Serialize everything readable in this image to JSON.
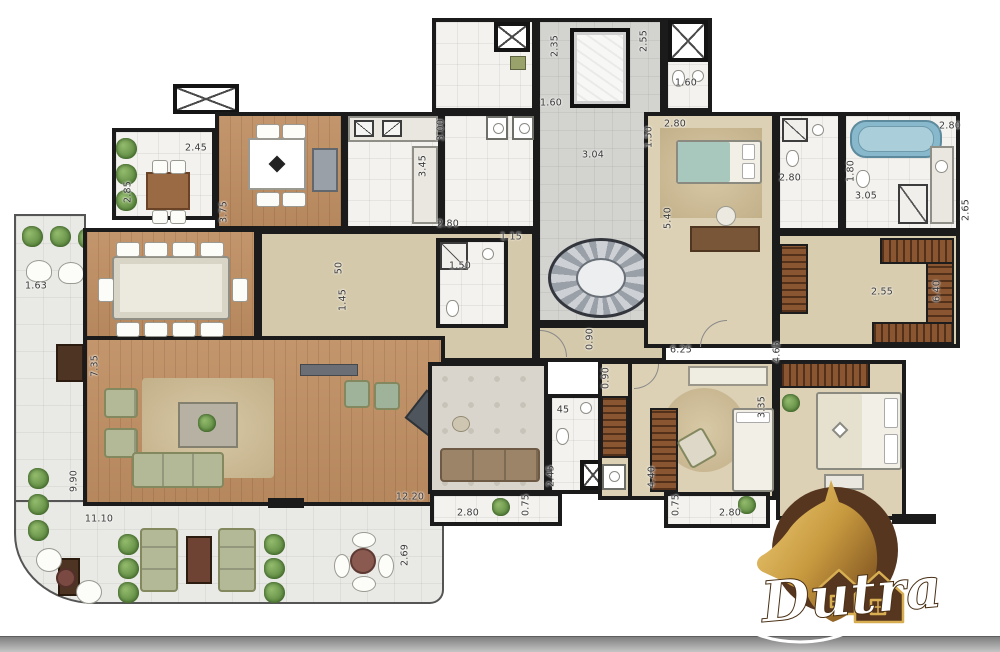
{
  "logo": {
    "brand": "Dutra"
  },
  "colors": {
    "wall": "#1b1b1b",
    "wood_floor": "#c08f63",
    "bedroom_floor": "#ddd1b5",
    "hall_floor": "#d5c9ab",
    "tile_floor": "#f3f2ee",
    "terrace_floor": "#e9e9e5",
    "bathtub_blue": "#87b8cc",
    "wardrobe_brown": "#8a5632",
    "sofa_green": "#b3b896",
    "logo_gold": "#d8ae52",
    "logo_brown": "#57361f",
    "bottom_bar_gray": "#b5b5b5"
  },
  "dimension_labels": [
    {
      "t": "2.45",
      "x": 196,
      "y": 148,
      "r": 0
    },
    {
      "t": "2.85",
      "x": 128,
      "y": 192,
      "r": -90
    },
    {
      "t": "3.75",
      "x": 224,
      "y": 212,
      "r": -90
    },
    {
      "t": "3.45",
      "x": 423,
      "y": 166,
      "r": -90
    },
    {
      "t": "3.00",
      "x": 441,
      "y": 130,
      "r": -90
    },
    {
      "t": "2.35",
      "x": 555,
      "y": 46,
      "r": -90
    },
    {
      "t": "2.55",
      "x": 644,
      "y": 41,
      "r": -90
    },
    {
      "t": "1.60",
      "x": 551,
      "y": 103,
      "r": 0
    },
    {
      "t": "3.04",
      "x": 593,
      "y": 155,
      "r": 0
    },
    {
      "t": "1.60",
      "x": 686,
      "y": 83,
      "r": 0
    },
    {
      "t": "2.80",
      "x": 675,
      "y": 124,
      "r": 0
    },
    {
      "t": "1.50",
      "x": 649,
      "y": 137,
      "r": -90
    },
    {
      "t": "5.40",
      "x": 668,
      "y": 218,
      "r": -90
    },
    {
      "t": "2.80",
      "x": 790,
      "y": 178,
      "r": 0
    },
    {
      "t": "2.80",
      "x": 950,
      "y": 126,
      "r": 0
    },
    {
      "t": "1.80",
      "x": 851,
      "y": 171,
      "r": -90
    },
    {
      "t": "3.05",
      "x": 866,
      "y": 196,
      "r": 0
    },
    {
      "t": "2.65",
      "x": 966,
      "y": 210,
      "r": -90
    },
    {
      "t": "2.55",
      "x": 882,
      "y": 292,
      "r": 0
    },
    {
      "t": "6.40",
      "x": 937,
      "y": 291,
      "r": -90
    },
    {
      "t": "1.63",
      "x": 36,
      "y": 286,
      "r": 0
    },
    {
      "t": "7.35",
      "x": 95,
      "y": 366,
      "r": -90
    },
    {
      "t": "9.90",
      "x": 74,
      "y": 481,
      "r": -90
    },
    {
      "t": "11.10",
      "x": 99,
      "y": 519,
      "r": 0
    },
    {
      "t": "12.20",
      "x": 410,
      "y": 497,
      "r": 0
    },
    {
      "t": "2.80",
      "x": 468,
      "y": 513,
      "r": 0
    },
    {
      "t": "0.75",
      "x": 526,
      "y": 505,
      "r": -90
    },
    {
      "t": "2.69",
      "x": 405,
      "y": 555,
      "r": -90
    },
    {
      "t": "2.45",
      "x": 551,
      "y": 476,
      "r": -90
    },
    {
      "t": "4.40",
      "x": 652,
      "y": 477,
      "r": -90
    },
    {
      "t": "45",
      "x": 563,
      "y": 410,
      "r": 0
    },
    {
      "t": "1.50",
      "x": 460,
      "y": 266,
      "r": 0
    },
    {
      "t": "1.15",
      "x": 511,
      "y": 237,
      "r": 0
    },
    {
      "t": "2.80",
      "x": 448,
      "y": 224,
      "r": 0
    },
    {
      "t": "1.45",
      "x": 343,
      "y": 300,
      "r": -90
    },
    {
      "t": "50",
      "x": 339,
      "y": 268,
      "r": -90
    },
    {
      "t": "0.90",
      "x": 590,
      "y": 339,
      "r": -90
    },
    {
      "t": "0.90",
      "x": 606,
      "y": 378,
      "r": -90
    },
    {
      "t": "6.25",
      "x": 681,
      "y": 350,
      "r": 0
    },
    {
      "t": "3.35",
      "x": 762,
      "y": 407,
      "r": -90
    },
    {
      "t": "4.65",
      "x": 777,
      "y": 352,
      "r": -90
    },
    {
      "t": "2.69",
      "x": 892,
      "y": 546,
      "r": -90
    },
    {
      "t": "2.80",
      "x": 730,
      "y": 513,
      "r": 0
    },
    {
      "t": "0.75",
      "x": 676,
      "y": 505,
      "r": -90
    }
  ]
}
